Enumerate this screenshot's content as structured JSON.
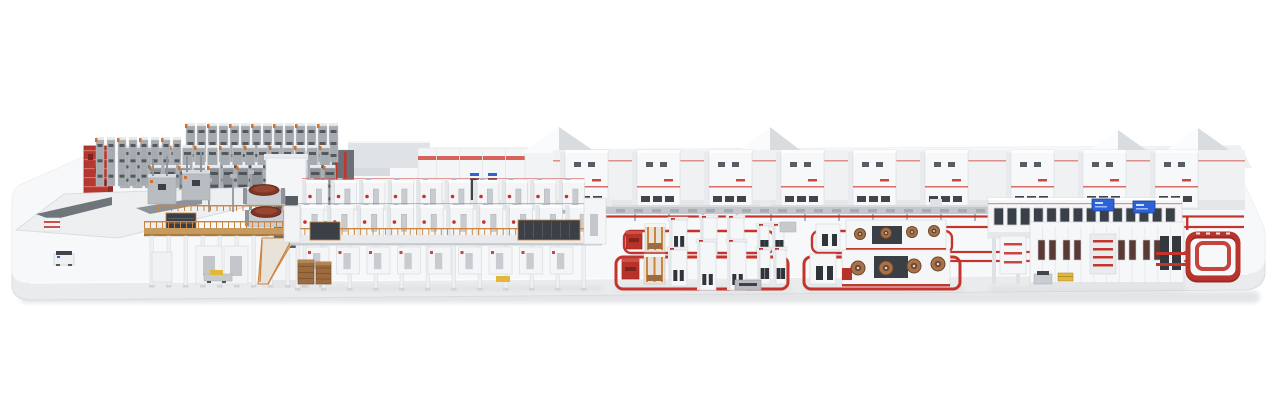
{
  "scene": {
    "subject": "corrugated-board-production-line-3d-render",
    "canvas": {
      "width": 1280,
      "height": 405
    },
    "visible_text": []
  },
  "palette": {
    "background": "#ffffff",
    "platform_top": "#f7f8f9",
    "platform_front": "#e9ebed",
    "platform_edge": "#d9dcdf",
    "shadow": "#e3e5e7",
    "machine_white": "#f5f6f8",
    "machine_shade": "#e6e9ec",
    "outline": "#d6d9dd",
    "steel": "#b4b8bd",
    "steel_mid": "#8f949a",
    "steel_dark": "#3c4147",
    "slot_dark": "#2f343a",
    "accent_red": "#c5342c",
    "accent_red_deep": "#9a2a22",
    "accent_red_light": "#cf5049",
    "scaffold_orange": "#cc8440",
    "orange_cap": "#d4702e",
    "wood_tan": "#c99a5e",
    "wood_edge": "#a87b43",
    "paper_brown": "#9c6b3f",
    "roll_dark": "#7e3526",
    "roll_face": "#a5724a",
    "screen_blue": "#2e63d8",
    "pallet_yellow": "#e3b63c"
  },
  "sections": [
    {
      "id": "base-platform"
    },
    {
      "id": "background-halls"
    },
    {
      "id": "roll-storage-racks"
    },
    {
      "id": "red-storage-rack"
    },
    {
      "id": "roll-handling-plaza"
    },
    {
      "id": "splicer-tower"
    },
    {
      "id": "corrugator-wet-end"
    },
    {
      "id": "dryer-bridge-section"
    },
    {
      "id": "utility-cabinet-row"
    },
    {
      "id": "rear-conveyor"
    },
    {
      "id": "red-transport-lines"
    },
    {
      "id": "converting-group-1"
    },
    {
      "id": "converting-group-2"
    },
    {
      "id": "logistics-building"
    },
    {
      "id": "shipping-loop"
    },
    {
      "id": "agv-and-pallets"
    }
  ],
  "elements": {
    "rack_stripes": [
      {
        "x0": 186,
        "step": 11,
        "count": 14,
        "y": 126,
        "w": 9,
        "h": 36,
        "tone": "light"
      },
      {
        "x0": 120,
        "step": 12.5,
        "count": 17,
        "y": 148,
        "w": 10,
        "h": 40,
        "tone": "light"
      },
      {
        "x0": 96,
        "step": 11,
        "count": 8,
        "y": 140,
        "w": 8,
        "h": 46,
        "tone": "light"
      },
      {
        "x0": 150,
        "step": 14.5,
        "count": 13,
        "y": 168,
        "w": 11.5,
        "h": 38,
        "tone": "dark"
      }
    ],
    "cabinets": {
      "xs": [
        560,
        632,
        704,
        776,
        848,
        920,
        1006,
        1078,
        1150
      ],
      "y": 150,
      "w": 48,
      "h": 58
    },
    "dryer": {
      "back_row": {
        "x0": 302,
        "step": 28.5,
        "count": 10,
        "y": 180,
        "w": 26,
        "h": 30
      },
      "front_row": {
        "x0": 297,
        "step": 29.8,
        "count": 10,
        "y": 205,
        "w": 27,
        "h": 31
      },
      "under_deck": {
        "x0": 306,
        "step": 30.5,
        "count": 9,
        "y": 247,
        "w": 23,
        "h": 27
      },
      "columns": {
        "x0": 296,
        "step": 26,
        "count": 12,
        "y": 242,
        "h": 46
      }
    },
    "red_lines": [
      {
        "x1": 585,
        "y": 216.5,
        "x2": 1244
      },
      {
        "x1": 846,
        "y": 227,
        "x2": 1244
      },
      {
        "x1": 938,
        "y": 252,
        "x2": 1188
      },
      {
        "x1": 938,
        "y": 261,
        "x2": 1188
      }
    ],
    "loops": {
      "groupA": {
        "back": [
          624,
          231,
          150,
          22
        ],
        "front": [
          616,
          257,
          172,
          32
        ]
      },
      "groupB": {
        "back": [
          812,
          231,
          140,
          22
        ],
        "front": [
          804,
          257,
          156,
          32
        ]
      }
    },
    "towers_groupA": {
      "back": [
        [
          700,
          218
        ],
        [
          727,
          218
        ]
      ],
      "front": [
        [
          697,
          242
        ],
        [
          727,
          242
        ]
      ]
    },
    "rolls_groupB": {
      "back": [
        [
          860,
          234
        ],
        [
          886,
          233
        ],
        [
          912,
          232
        ],
        [
          934,
          231
        ]
      ],
      "front": [
        [
          858,
          268
        ],
        [
          886,
          268
        ],
        [
          914,
          266
        ],
        [
          938,
          264
        ]
      ]
    },
    "building": {
      "upper_windows": {
        "x0": 994,
        "step": 13.2,
        "count": 14,
        "y": 208,
        "w": 9.5,
        "h": 17
      },
      "screens": [
        {
          "x": 1092,
          "y": 199,
          "w": 22,
          "h": 12
        },
        {
          "x": 1133,
          "y": 201,
          "w": 22,
          "h": 12
        }
      ],
      "lower_window_cols": [
        1038,
        1063,
        1118,
        1143
      ],
      "middle_shelves": 4,
      "doors": [
        1160,
        1172
      ]
    }
  }
}
